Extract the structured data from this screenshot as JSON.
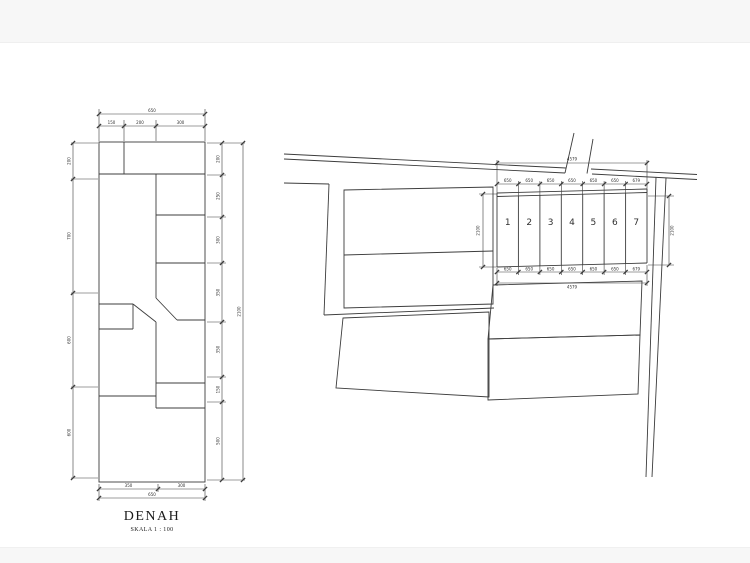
{
  "page": {
    "background_color": "#ffffff",
    "band_color": "#f7f7f7",
    "line_color": "#3c3c3c"
  },
  "floor_plan": {
    "title": "DENAH",
    "scale_label": "SKALA 1 : 100",
    "dims": {
      "top_total": "650",
      "top_segments": [
        "150",
        "200",
        "300"
      ],
      "bottom_segments": [
        "350",
        "300"
      ],
      "bottom_total": "650",
      "left_segments": [
        "200",
        "700",
        "600",
        "600"
      ],
      "right_segments": [
        "200",
        "250",
        "300",
        "350",
        "350",
        "150",
        "500"
      ],
      "right_total": "2100"
    }
  },
  "site_plan": {
    "lots": [
      "1",
      "2",
      "3",
      "4",
      "5",
      "6",
      "7"
    ],
    "dims": {
      "top_total": "4579",
      "top_segments": [
        "650",
        "650",
        "650",
        "650",
        "650",
        "650",
        "679"
      ],
      "bottom_segments": [
        "650",
        "650",
        "650",
        "650",
        "650",
        "650",
        "679"
      ],
      "bottom_total": "4579",
      "left_depth": "2100",
      "right_depth": "2100"
    }
  }
}
